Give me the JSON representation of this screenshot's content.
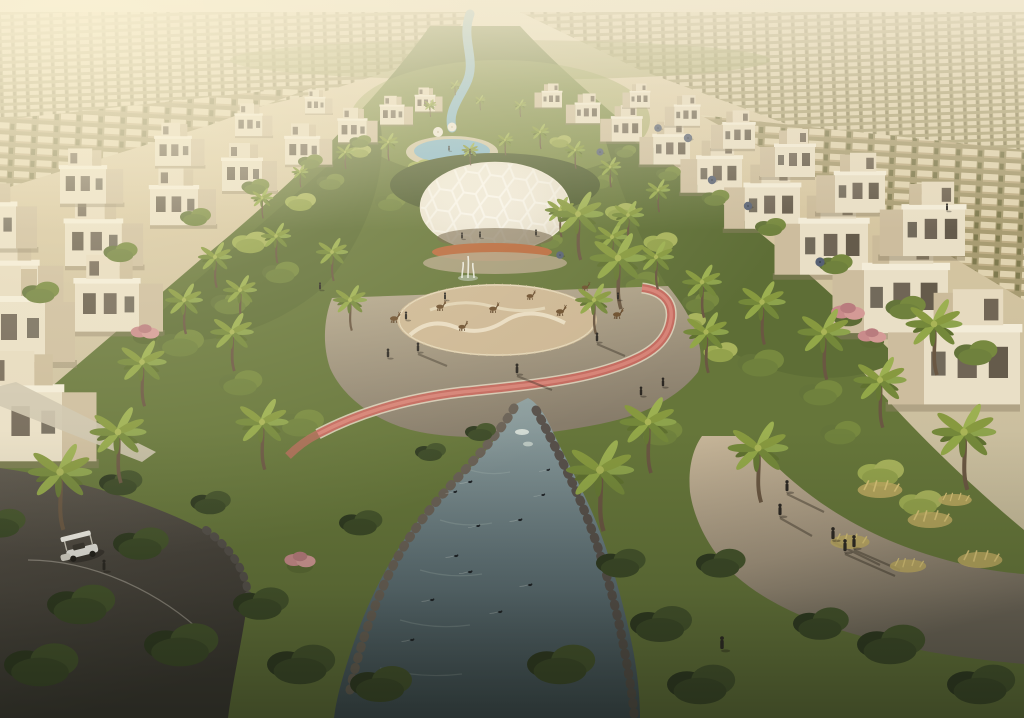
{
  "image": {
    "kind": "architectural-aerial-render",
    "description": "Golden-hour aerial rendering of a villa community: rows of cream cubic villas flank a central landscaped park corridor with palm trees, a white honeycomb dome pavilion, a gazelle enclosure, a pink jogging track, a winding blue lagoon pool at the top and a rocky stream with ducks at the bottom; a golf buggy drives a dark path lower-left and people walk a sunlit path lower-right.",
    "sun_direction": "upper-left",
    "landmarks": [
      "distant-suburb-rows",
      "villas-left",
      "villas-right",
      "central-park-corridor",
      "lagoon-pool",
      "dome-pavilion",
      "fountain",
      "gazelle-enclosure",
      "jogging-track",
      "duck-stream",
      "buggy-path",
      "sunlit-walkway",
      "golf-buggy"
    ]
  },
  "palette": {
    "sky_haze": "#efe5cb",
    "sand_far": "#cdbd99",
    "villa_lit": "#e9dfc6",
    "villa_shade": "#cdbd9e",
    "green_bright": "#a8b35c",
    "green_mid": "#6f813d",
    "green_dark": "#3c4a27",
    "palm_frond": "#8da34c",
    "water_lagoon": "#85b7cb",
    "water_stream": "#6f8184",
    "track_red": "#c46a5f",
    "path_light": "#c2b196",
    "path_dark": "#4f4a42",
    "dome_white": "#f0eadb",
    "sand_enclosure": "#cdb794",
    "flower_orange": "#b96a3e",
    "flower_pink": "#c98b8b",
    "rock_grey": "#6a6156",
    "figure_dark": "#2c2823",
    "cart_white": "#ebe9e2",
    "grass_gold": "#c0ab62",
    "umbrella_slate": "#566074"
  },
  "scene": {
    "villas_left": [
      [
        415,
        96,
        0.5
      ],
      [
        380,
        106,
        0.6
      ],
      [
        338,
        120,
        0.72
      ],
      [
        285,
        138,
        0.86
      ],
      [
        222,
        160,
        1.0
      ],
      [
        150,
        188,
        1.2
      ],
      [
        65,
        222,
        1.42
      ],
      [
        -30,
        264,
        1.7
      ],
      [
        305,
        98,
        0.5
      ],
      [
        235,
        115,
        0.68
      ],
      [
        155,
        138,
        0.9
      ],
      [
        60,
        168,
        1.15
      ],
      [
        -40,
        205,
        1.4
      ],
      [
        -35,
        300,
        2.0
      ],
      [
        75,
        282,
        1.6
      ],
      [
        -30,
        390,
        2.3
      ]
    ],
    "villas_right": [
      [
        562,
        92,
        0.5,
        -1
      ],
      [
        600,
        104,
        0.62,
        -1
      ],
      [
        642,
        118,
        0.76,
        -1
      ],
      [
        690,
        136,
        0.92,
        -1
      ],
      [
        742,
        158,
        1.12,
        -1
      ],
      [
        800,
        186,
        1.38,
        -1
      ],
      [
        868,
        222,
        1.7,
        -1
      ],
      [
        948,
        268,
        2.1,
        -1
      ],
      [
        650,
        92,
        0.5,
        -1
      ],
      [
        700,
        106,
        0.64,
        -1
      ],
      [
        755,
        124,
        0.8,
        -1
      ],
      [
        815,
        146,
        1.0,
        -1
      ],
      [
        885,
        174,
        1.25,
        -1
      ],
      [
        965,
        208,
        1.55,
        -1
      ],
      [
        1020,
        330,
        2.4,
        -1
      ]
    ],
    "palms": [
      [
        430,
        105,
        0.35
      ],
      [
        480,
        100,
        0.3
      ],
      [
        455,
        85,
        0.3
      ],
      [
        520,
        105,
        0.35
      ],
      [
        300,
        172,
        0.45
      ],
      [
        345,
        152,
        0.5
      ],
      [
        388,
        142,
        0.55
      ],
      [
        540,
        132,
        0.5
      ],
      [
        575,
        150,
        0.55
      ],
      [
        610,
        167,
        0.6
      ],
      [
        262,
        198,
        0.6
      ],
      [
        658,
        190,
        0.65
      ],
      [
        470,
        150,
        0.45
      ],
      [
        505,
        140,
        0.45
      ],
      [
        215,
        257,
        0.9
      ],
      [
        276,
        236,
        0.8
      ],
      [
        332,
        252,
        0.85
      ],
      [
        612,
        237,
        0.9
      ],
      [
        656,
        257,
        0.95
      ],
      [
        702,
        282,
        1.05
      ],
      [
        184,
        300,
        1.0
      ],
      [
        594,
        300,
        1.0
      ],
      [
        560,
        210,
        0.8
      ],
      [
        628,
        215,
        0.85
      ],
      [
        240,
        290,
        0.9
      ],
      [
        350,
        300,
        0.9
      ],
      [
        578,
        214,
        1.35
      ],
      [
        618,
        258,
        1.5
      ],
      [
        142,
        362,
        1.3
      ],
      [
        232,
        332,
        1.15
      ],
      [
        706,
        332,
        1.2
      ],
      [
        762,
        302,
        1.25
      ],
      [
        824,
        332,
        1.4
      ],
      [
        118,
        432,
        1.5
      ],
      [
        262,
        422,
        1.4
      ],
      [
        648,
        422,
        1.5
      ],
      [
        758,
        448,
        1.6
      ],
      [
        934,
        324,
        1.5
      ],
      [
        964,
        432,
        1.7
      ],
      [
        880,
        380,
        1.4
      ],
      [
        60,
        472,
        1.7
      ],
      [
        600,
        470,
        1.8
      ]
    ],
    "bushes_bright": [
      [
        360,
        150,
        0.7
      ],
      [
        420,
        165,
        0.8
      ],
      [
        470,
        185,
        0.9
      ],
      [
        540,
        170,
        0.8
      ],
      [
        300,
        200,
        1
      ],
      [
        250,
        240,
        1.2
      ],
      [
        620,
        210,
        1
      ],
      [
        660,
        240,
        1.1
      ],
      [
        580,
        330,
        1.3
      ],
      [
        620,
        355,
        1.2
      ],
      [
        350,
        330,
        1.1
      ],
      [
        560,
        140,
        0.7
      ],
      [
        880,
        470,
        1.5
      ],
      [
        920,
        500,
        1.4
      ],
      [
        690,
        320,
        1
      ],
      [
        720,
        350,
        1.1
      ]
    ],
    "bushes_mid": [
      [
        330,
        180,
        0.9
      ],
      [
        390,
        200,
        1
      ],
      [
        450,
        215,
        1
      ],
      [
        520,
        200,
        0.9
      ],
      [
        280,
        270,
        1.2
      ],
      [
        230,
        300,
        1.3
      ],
      [
        640,
        280,
        1.2
      ],
      [
        700,
        300,
        1.2
      ],
      [
        180,
        340,
        1.5
      ],
      [
        760,
        360,
        1.5
      ],
      [
        820,
        390,
        1.4
      ],
      [
        480,
        250,
        0.8
      ],
      [
        550,
        240,
        0.8
      ],
      [
        600,
        180,
        0.8
      ],
      [
        840,
        430,
        1.3
      ],
      [
        240,
        380,
        1.4
      ],
      [
        300,
        420,
        1.5
      ],
      [
        660,
        430,
        1.4
      ],
      [
        360,
        140,
        0.7
      ],
      [
        310,
        160,
        0.8
      ],
      [
        255,
        185,
        0.9
      ],
      [
        195,
        215,
        1.0
      ],
      [
        120,
        250,
        1.1
      ],
      [
        40,
        290,
        1.2
      ],
      [
        625,
        150,
        0.7
      ],
      [
        668,
        172,
        0.8
      ],
      [
        715,
        196,
        0.9
      ],
      [
        770,
        225,
        1.0
      ],
      [
        835,
        262,
        1.1
      ],
      [
        905,
        305,
        1.3
      ],
      [
        975,
        350,
        1.4
      ]
    ],
    "bushes_dark": [
      [
        80,
        600,
        2.2
      ],
      [
        180,
        640,
        2.4
      ],
      [
        300,
        660,
        2.2
      ],
      [
        260,
        600,
        1.8
      ],
      [
        380,
        680,
        2
      ],
      [
        560,
        660,
        2.2
      ],
      [
        660,
        620,
        2
      ],
      [
        700,
        680,
        2.2
      ],
      [
        140,
        540,
        1.8
      ],
      [
        40,
        660,
        2.4
      ],
      [
        620,
        560,
        1.6
      ],
      [
        720,
        560,
        1.6
      ],
      [
        480,
        430,
        1
      ],
      [
        430,
        450,
        1
      ],
      [
        360,
        520,
        1.4
      ],
      [
        890,
        640,
        2.2
      ],
      [
        980,
        680,
        2.2
      ],
      [
        820,
        620,
        1.8
      ],
      [
        120,
        480,
        1.4
      ],
      [
        210,
        500,
        1.3
      ],
      [
        0,
        520,
        1.6
      ]
    ],
    "bushes_flower": [
      [
        145,
        332,
        1.1
      ],
      [
        848,
        312,
        1.3
      ],
      [
        872,
        336,
        1.1
      ],
      [
        300,
        560,
        1.2
      ]
    ],
    "grass_patches": [
      [
        880,
        490,
        1.6
      ],
      [
        930,
        520,
        1.6
      ],
      [
        850,
        542,
        1.4
      ],
      [
        980,
        560,
        1.6
      ],
      [
        908,
        566,
        1.3
      ],
      [
        955,
        500,
        1.2
      ]
    ],
    "gazelles": [
      [
        394,
        322,
        1
      ],
      [
        440,
        310,
        0.95
      ],
      [
        493,
        312,
        0.95
      ],
      [
        530,
        299,
        0.85
      ],
      [
        560,
        315,
        1
      ],
      [
        617,
        318,
        1
      ],
      [
        462,
        330,
        0.9
      ],
      [
        585,
        290,
        0.8
      ]
    ],
    "ducks": [
      [
        470,
        482,
        1
      ],
      [
        455,
        492,
        0.9
      ],
      [
        543,
        495,
        0.9
      ],
      [
        520,
        520,
        1
      ],
      [
        478,
        526,
        0.95
      ],
      [
        456,
        556,
        1
      ],
      [
        432,
        600,
        1
      ],
      [
        500,
        612,
        1
      ],
      [
        412,
        640,
        1
      ],
      [
        548,
        470,
        0.85
      ],
      [
        470,
        572,
        1.05
      ],
      [
        530,
        585,
        1
      ]
    ],
    "umbrellas": [
      [
        688,
        138,
        1
      ],
      [
        712,
        180,
        1
      ],
      [
        748,
        206,
        1
      ],
      [
        820,
        262,
        1.1
      ],
      [
        658,
        128,
        0.9
      ],
      [
        600,
        152,
        0.85
      ],
      [
        560,
        255,
        0.9
      ]
    ],
    "pool_canopies": [
      [
        438,
        132,
        1
      ],
      [
        452,
        127,
        0.9
      ]
    ],
    "people": [
      [
        418,
        352,
        1
      ],
      [
        406,
        320,
        0.9
      ],
      [
        388,
        358,
        1
      ],
      [
        445,
        300,
        0.8
      ],
      [
        517,
        374,
        1.1
      ],
      [
        597,
        342,
        1
      ],
      [
        641,
        396,
        1
      ],
      [
        663,
        387,
        1
      ],
      [
        787,
        492,
        1.25
      ],
      [
        780,
        516,
        1.3
      ],
      [
        833,
        540,
        1.35
      ],
      [
        845,
        552,
        1.35
      ],
      [
        854,
        548,
        1.35
      ],
      [
        104,
        571,
        1.2
      ],
      [
        480,
        238,
        0.7
      ],
      [
        462,
        239,
        0.7
      ],
      [
        536,
        236,
        0.7
      ],
      [
        449,
        151,
        0.55
      ],
      [
        470,
        154,
        0.55
      ],
      [
        947,
        211,
        0.8
      ],
      [
        722,
        650,
        1.45
      ],
      [
        618,
        300,
        0.8
      ],
      [
        320,
        290,
        0.8
      ]
    ]
  }
}
